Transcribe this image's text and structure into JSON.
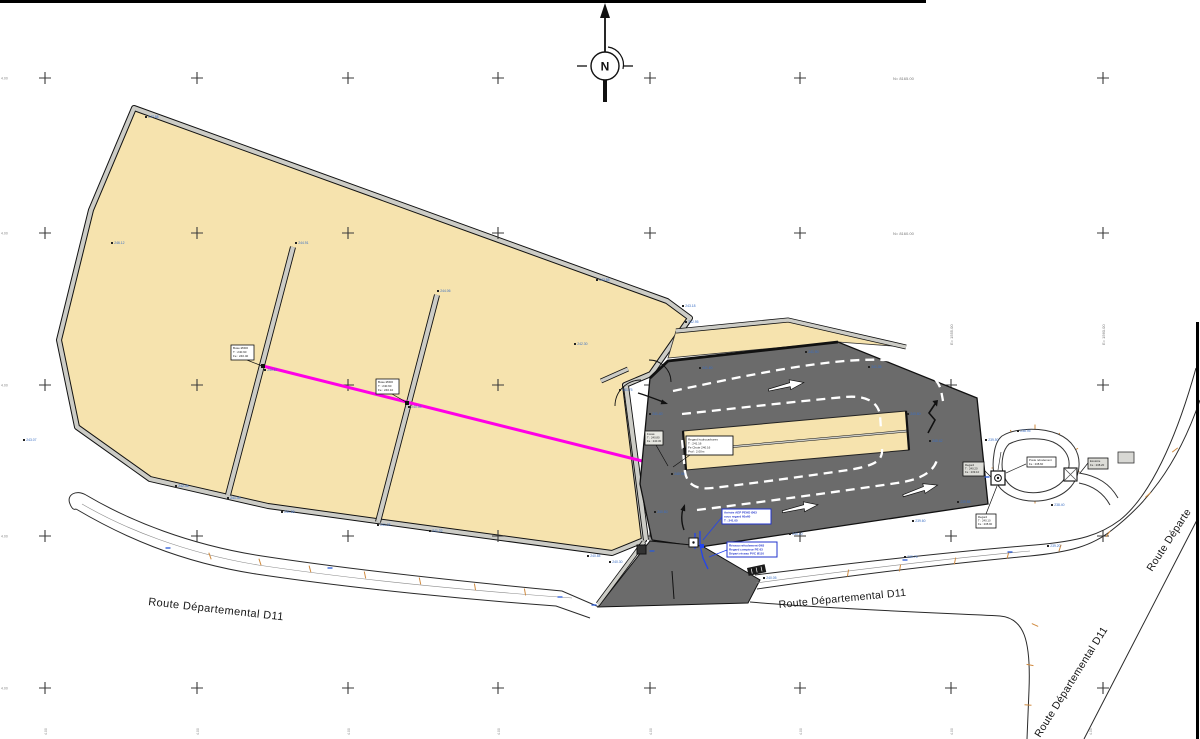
{
  "north_marker": {
    "letter": "N"
  },
  "roads": {
    "label_left": "Route Départemental D11",
    "label_center": "Route Départemental D11",
    "label_branch": "Route Départemental D11",
    "label_upper_right": "Route Départe"
  },
  "grid": {
    "cols": [
      45,
      197,
      348,
      498,
      650,
      800,
      951,
      1103
    ],
    "rows": [
      78,
      233,
      385,
      536,
      688
    ]
  },
  "coordinates": {
    "row_labels": [
      {
        "x": 893,
        "y": 80,
        "text": "N= 8165.00"
      },
      {
        "x": 893,
        "y": 235,
        "text": "N= 8160.00"
      }
    ],
    "col_labels_rotated": [
      {
        "x": 953,
        "y": 345,
        "text": "E= 1555.00"
      },
      {
        "x": 1105,
        "y": 345,
        "text": "E= 1560.00"
      }
    ],
    "left_edge_rows": [
      78,
      233,
      385,
      536,
      688
    ],
    "left_edge_text": "4.00",
    "bottom_edge_cols": [
      45,
      197,
      348,
      498,
      650,
      800,
      951,
      1090
    ],
    "bottom_edge_text": "4.00"
  },
  "callouts": {
    "buse1": {
      "lines": [
        "Buse Ø300",
        "T : 240.90",
        "Fe : 240.40"
      ]
    },
    "buse2": {
      "lines": [
        "Buse Ø300",
        "T : 240.60",
        "Fe : 240.10"
      ]
    },
    "fosse": {
      "lines": [
        "Fossé",
        "T : 240.80",
        "Fe : 240.30"
      ]
    },
    "regard_hydro": {
      "lines": [
        "Regard hydrocarbures",
        "T : 241.16",
        "Fe Chute 240.16",
        "Prof : 2.00m"
      ]
    },
    "aep": {
      "lines": [
        "Arrivée AEP PEHD Ø63",
        "sous regard 60x60",
        "T : 241.05"
      ]
    },
    "refoulement": {
      "lines": [
        "Réseau refoulement Ø63",
        "Regard compteur PE 63",
        "Départ réseau PVC Ø110"
      ]
    },
    "regard_droite": {
      "lines": [
        "Regard",
        "T : 240.20",
        "Fe : 239.10"
      ]
    },
    "regard_pompe": {
      "lines": [
        "Regard",
        "T : 240.10",
        "Fe : 238.90"
      ]
    },
    "poste": {
      "lines": [
        "Poste refoulement",
        "Fe : 238.60"
      ]
    },
    "exutoire": {
      "lines": [
        "Exutoire",
        "Fe : 238.20"
      ]
    }
  },
  "elevations": [
    {
      "x": 146,
      "y": 117,
      "v": "247.88"
    },
    {
      "x": 112,
      "y": 243,
      "v": "246.12"
    },
    {
      "x": 24,
      "y": 440,
      "v": "243.07"
    },
    {
      "x": 176,
      "y": 486,
      "v": "242.46"
    },
    {
      "x": 282,
      "y": 512,
      "v": "241.98"
    },
    {
      "x": 430,
      "y": 531,
      "v": "241.22"
    },
    {
      "x": 588,
      "y": 556,
      "v": "240.84"
    },
    {
      "x": 296,
      "y": 243,
      "v": "244.91"
    },
    {
      "x": 438,
      "y": 291,
      "v": "244.06"
    },
    {
      "x": 265,
      "y": 370,
      "v": "240.87"
    },
    {
      "x": 409,
      "y": 407,
      "v": "240.55"
    },
    {
      "x": 378,
      "y": 525,
      "v": "241.05"
    },
    {
      "x": 228,
      "y": 498,
      "v": "241.40"
    },
    {
      "x": 597,
      "y": 280,
      "v": "243.55"
    },
    {
      "x": 683,
      "y": 306,
      "v": "243.18"
    },
    {
      "x": 686,
      "y": 322,
      "v": "242.95"
    },
    {
      "x": 575,
      "y": 344,
      "v": "242.30"
    },
    {
      "x": 620,
      "y": 390,
      "v": "241.75"
    },
    {
      "x": 650,
      "y": 414,
      "v": "241.40"
    },
    {
      "x": 672,
      "y": 474,
      "v": "240.98"
    },
    {
      "x": 700,
      "y": 368,
      "v": "241.60"
    },
    {
      "x": 806,
      "y": 352,
      "v": "241.90"
    },
    {
      "x": 869,
      "y": 367,
      "v": "241.35"
    },
    {
      "x": 908,
      "y": 414,
      "v": "240.80"
    },
    {
      "x": 930,
      "y": 441,
      "v": "240.42"
    },
    {
      "x": 958,
      "y": 502,
      "v": "239.85"
    },
    {
      "x": 913,
      "y": 521,
      "v": "239.60"
    },
    {
      "x": 790,
      "y": 534,
      "v": "240.10"
    },
    {
      "x": 655,
      "y": 512,
      "v": "240.60"
    },
    {
      "x": 610,
      "y": 562,
      "v": "240.30"
    },
    {
      "x": 1048,
      "y": 546,
      "v": "239.20"
    },
    {
      "x": 905,
      "y": 557,
      "v": "239.75"
    },
    {
      "x": 1018,
      "y": 431,
      "v": "238.95"
    },
    {
      "x": 1052,
      "y": 505,
      "v": "238.40"
    },
    {
      "x": 764,
      "y": 578,
      "v": "240.05"
    },
    {
      "x": 986,
      "y": 440,
      "v": "239.50"
    }
  ]
}
